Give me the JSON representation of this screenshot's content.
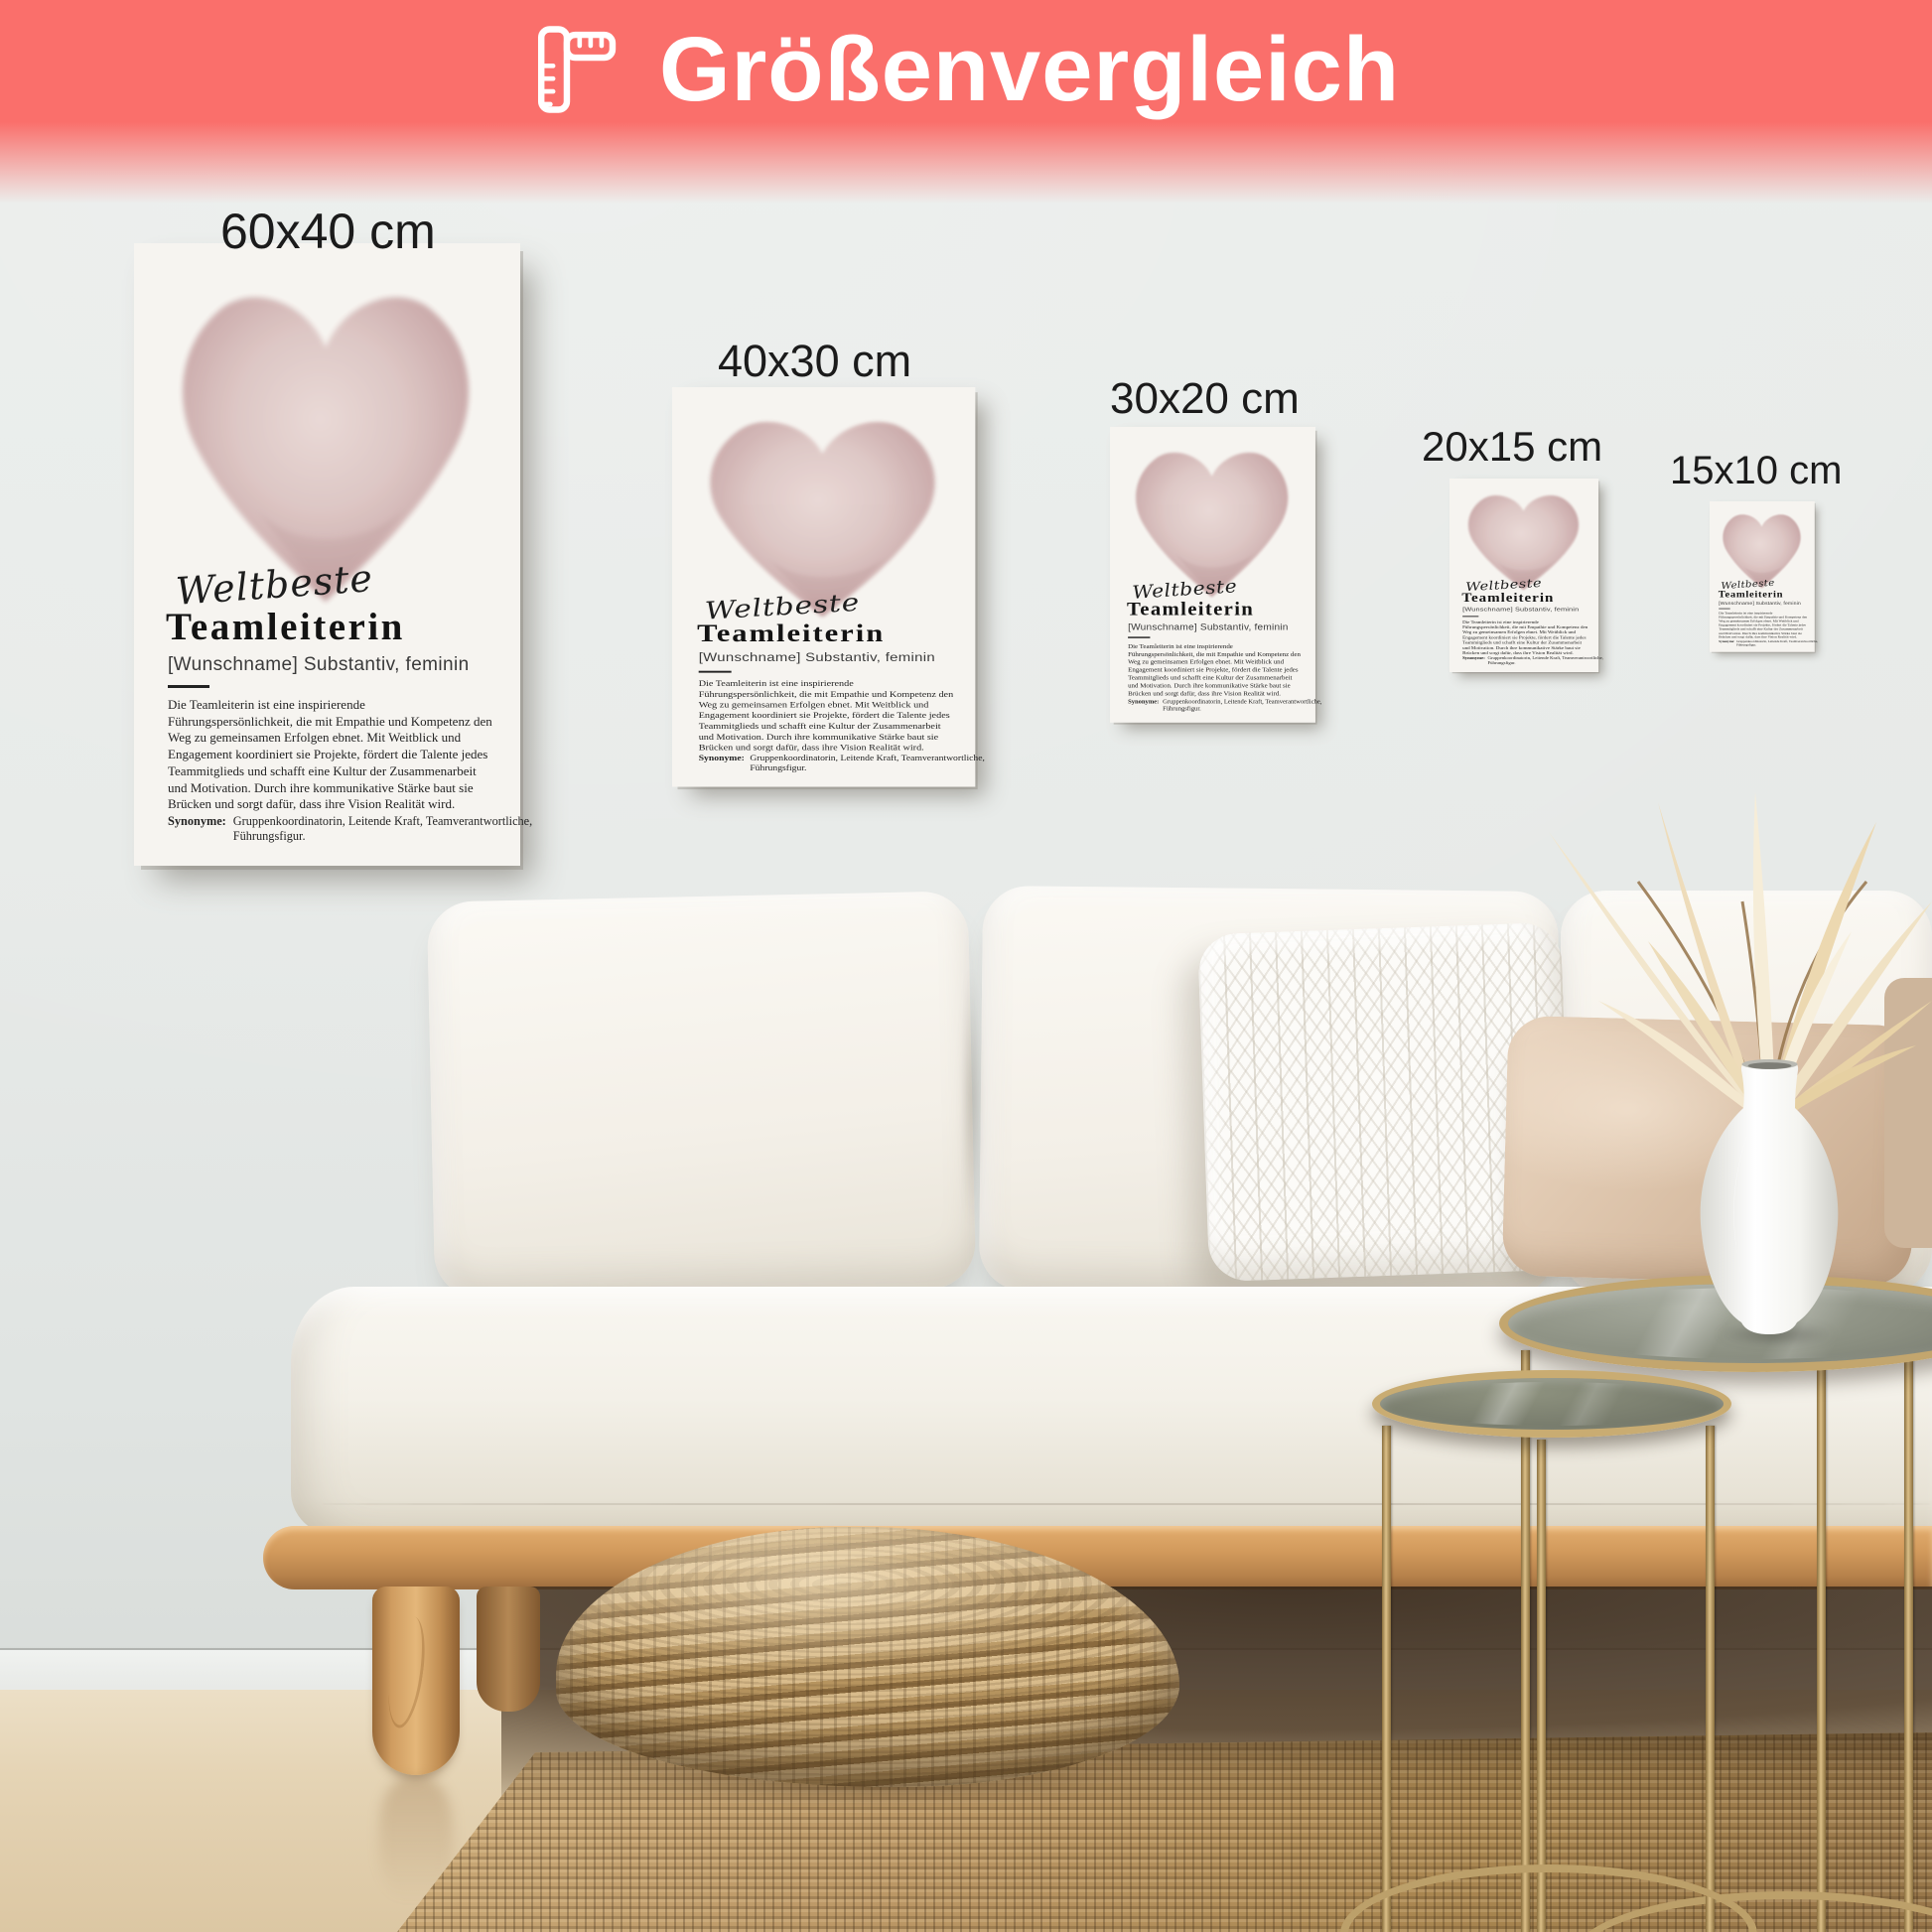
{
  "banner": {
    "title": "Größenvergleich",
    "icon": "ruler-icon",
    "color": "#fa6f6b",
    "text_color": "#ffffff"
  },
  "size_labels": [
    {
      "label": "60x40 cm"
    },
    {
      "label": "40x30 cm"
    },
    {
      "label": "30x20 cm"
    },
    {
      "label": "20x15 cm"
    },
    {
      "label": "15x10 cm"
    }
  ],
  "poster": {
    "script_word": "Weltbeste",
    "title": "Teamleiterin",
    "subtitle": "[Wunschname] Substantiv, feminin",
    "body": "Die Teamleiterin ist eine inspirierende\nFührungspersönlichkeit, die mit Empathie und Kompetenz den\nWeg zu gemeinsamen Erfolgen ebnet. Mit Weitblick und\nEngagement koordiniert sie Projekte, fördert die Talente jedes\nTeammitglieds und schafft eine Kultur der Zusammenarbeit\nund Motivation. Durch ihre kommunikative Stärke baut sie\nBrücken und sorgt dafür, dass ihre Vision Realität wird.",
    "synonyms_label": "Synonyme:",
    "synonyms": "Gruppenkoordinatorin, Leitende Kraft, Teamverantwortliche,\nFührungsfigur.",
    "heart_color": "#c7a4a4",
    "paper_color": "#f6f4f0"
  },
  "scene_colors": {
    "wall": "#e7eae8",
    "floor_wood": "#e5d4b5",
    "sofa_fabric": "#f3efe7",
    "wood_frame": "#d29a5c",
    "rug_jute": "#bb9765",
    "pouf_seagrass": "#c3a26e",
    "table_brass": "#c3a66e",
    "pillow_beige": "#dcc3aa"
  }
}
